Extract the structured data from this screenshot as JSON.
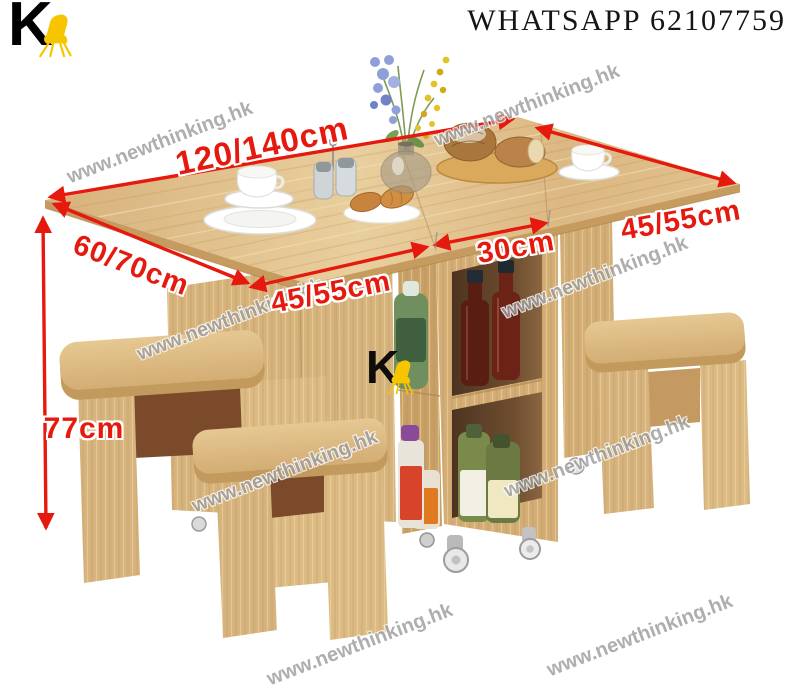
{
  "header": {
    "contact_label": "WHATSAPP 62107759"
  },
  "branding": {
    "logo_letter": "K",
    "logo_accent_color": "#f6c500",
    "watermark_text": "www.newthinking.hk"
  },
  "annotations": {
    "accent_color": "#e6190e",
    "table_length": "120/140cm",
    "right_leaf_depth": "45/55cm",
    "side_depth": "60/70cm",
    "left_leaf_width": "45/55cm",
    "center_width": "30cm",
    "table_height": "77cm"
  },
  "scene": {
    "description": "Folding wooden drop-leaf dining table with central storage shelves holding bottles, four wooden stools, coffee cups, plates, pastries, bread board and a flower vase",
    "wood_color": "#d9b379"
  }
}
